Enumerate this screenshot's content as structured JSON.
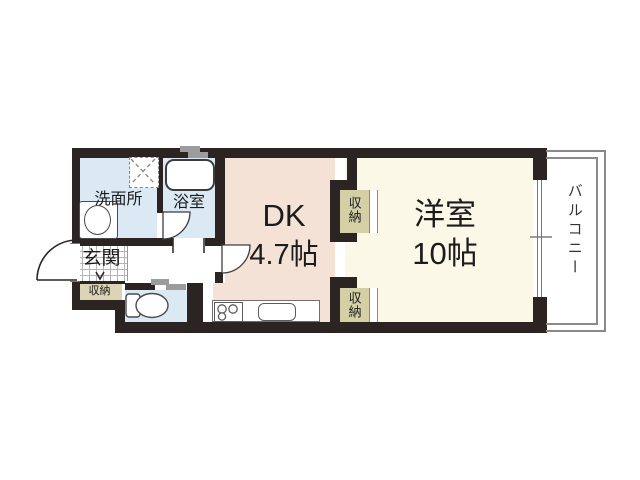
{
  "title": "1DK apartment floor plan",
  "labels": {
    "washroom": "洗面所",
    "bathroom": "浴室",
    "dk_name": "DK",
    "dk_size": "4.7帖",
    "western_name": "洋室",
    "western_size": "10帖",
    "entrance": "玄関",
    "entrance_storage": "収納",
    "closet_upper": "収納",
    "closet_lower": "収納",
    "balcony": "バルコニー"
  },
  "fixtures": [
    "bathtub-icon",
    "vanity-basin-icon",
    "washing-machine-pan-icon",
    "toilet-icon",
    "gas-stove-icon",
    "kitchen-sink-icon",
    "entrance-door-swing-icon",
    "bathroom-door-swing-icon",
    "dk-door-swing-icon",
    "sliding-window-icon",
    "toilet-sliding-door-icon",
    "entrance-step-arrow-icon"
  ],
  "colors": {
    "wall": "#2b2422",
    "water": "#dbe9f5",
    "dk": "#f5e2d6",
    "western": "#fbf8e8",
    "closet": "#d5cfa6",
    "storage": "#dbd5b5",
    "balconyline": "#8a8a8a",
    "fixline": "#4a4a4a",
    "windowgray": "#9c9c9c",
    "hatch": "#b5b5b5",
    "text": "#1c1c1c"
  }
}
